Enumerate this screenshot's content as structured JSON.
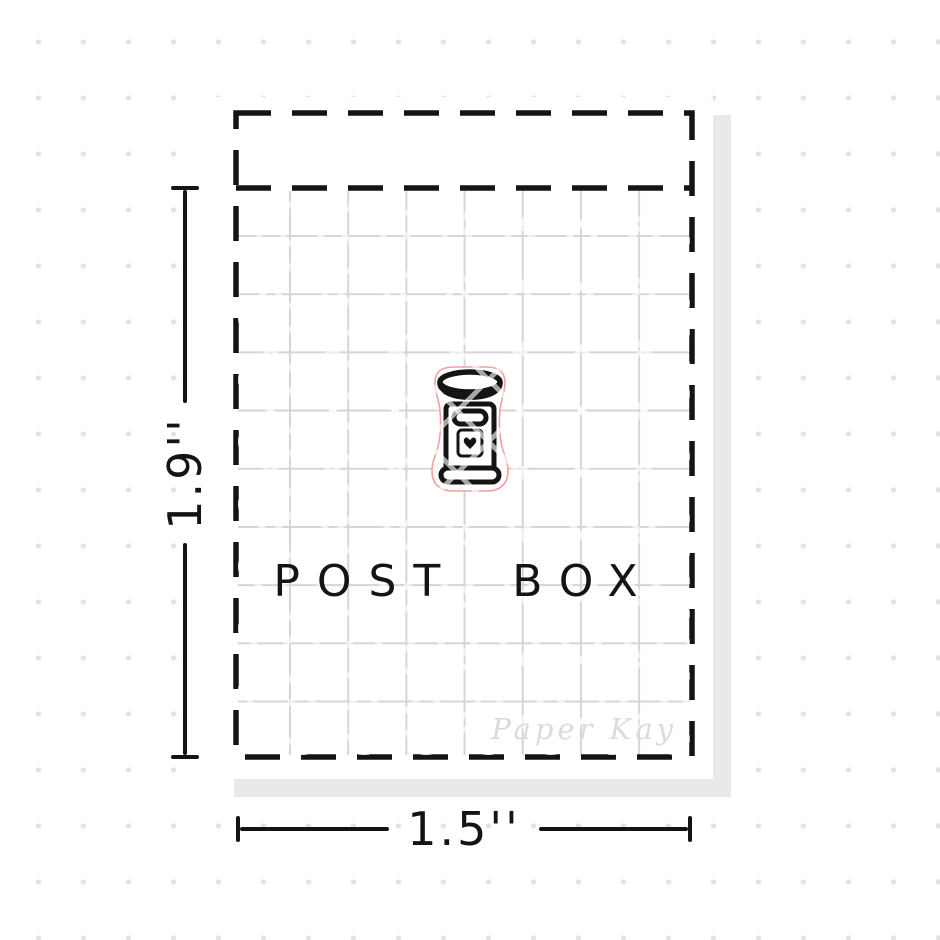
{
  "product": {
    "title": "POST BOX",
    "width_label": "1.5''",
    "height_label": "1.9''",
    "brand_watermark": "Paper Kay",
    "icon": "post-box-with-heart-sticker"
  },
  "colors": {
    "outline": "#141414",
    "grid_line": "#d5d5d5",
    "sticker_cut_line": "#f2a0a0",
    "sheet_shadow": "#e9e9e9",
    "brand_watermark_text": "#dbdbdb",
    "background_dots": "#e2e2e2"
  }
}
